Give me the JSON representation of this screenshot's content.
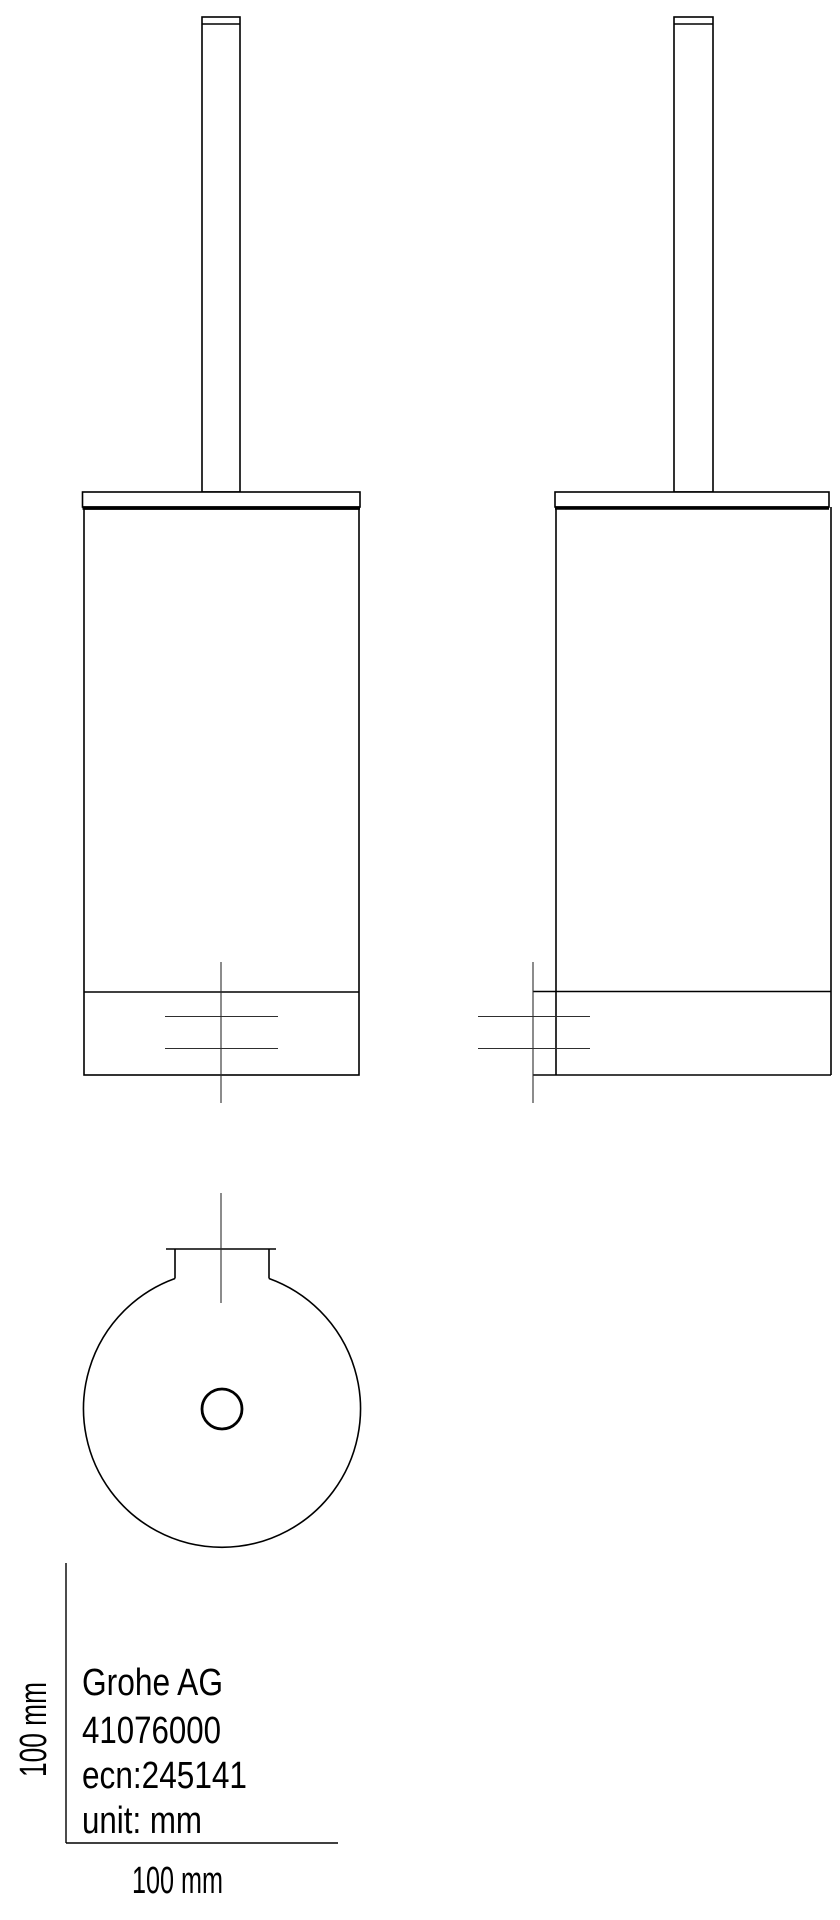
{
  "title_block": {
    "manufacturer": "Grohe AG",
    "product_code": "41076000",
    "ecn": "ecn:245141",
    "unit": "unit: mm"
  },
  "scale": {
    "horizontal_label": "100 mm",
    "vertical_label": "100 mm"
  },
  "colors": {
    "line": "#000000",
    "thin_line": "#2e2e2e",
    "background": "#ffffff"
  }
}
